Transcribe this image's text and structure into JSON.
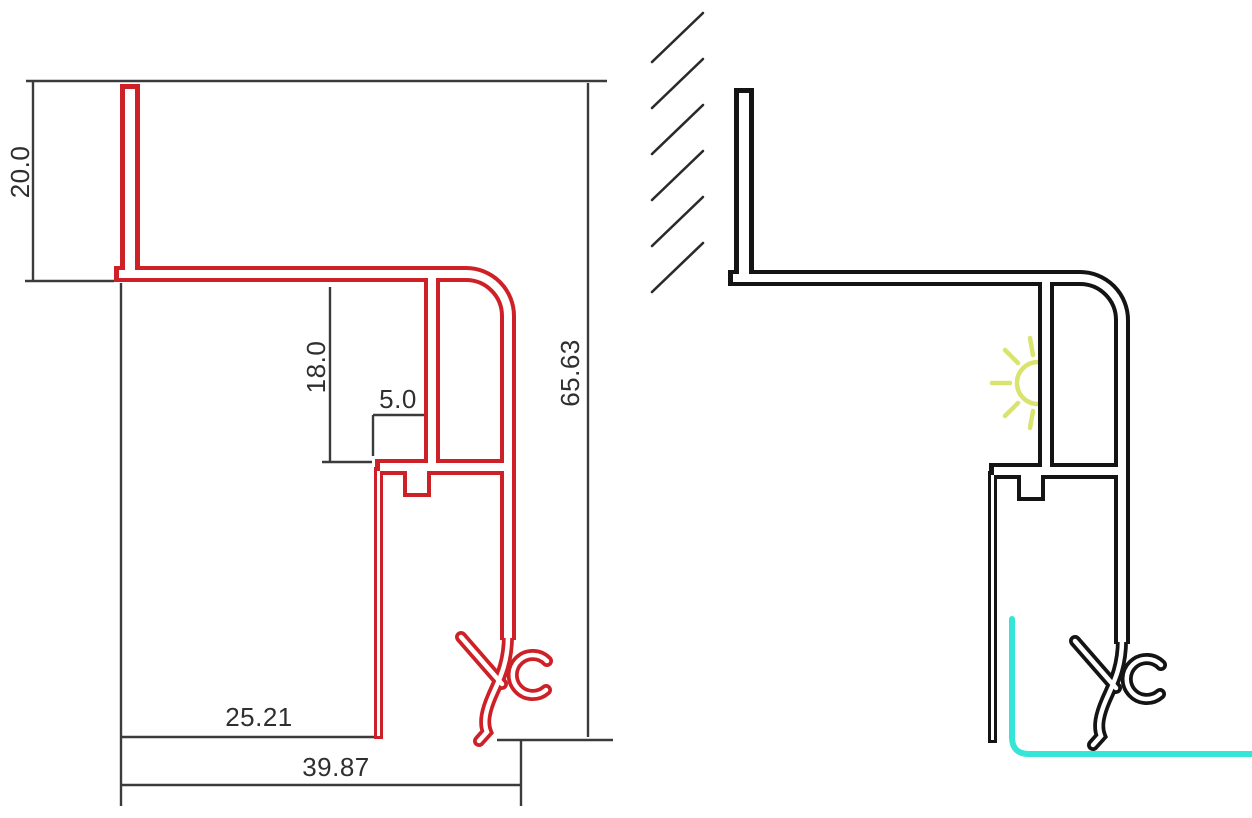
{
  "drawing": {
    "title": "aluminium-led-profile-cross-section",
    "views": {
      "left": "dimensioned-profile-outline",
      "right": "installation-view-with-wall-led-strip-and-light-emission"
    }
  },
  "dimensions": {
    "flange_height": "20.0",
    "chamber_depth": "18.0",
    "ledge_width": "5.0",
    "overall_height": "65.63",
    "body_width": "25.21",
    "overall_width": "39.87"
  },
  "colors": {
    "profile_left": "#ce2127",
    "profile_right": "#141414",
    "dimension": "#3b3b3b",
    "text": "#2f2f2f",
    "hatching": "#2a2a2a",
    "led_strip": "#35e6d8",
    "light_glow": "#d9e36e",
    "background": "#ffffff"
  }
}
